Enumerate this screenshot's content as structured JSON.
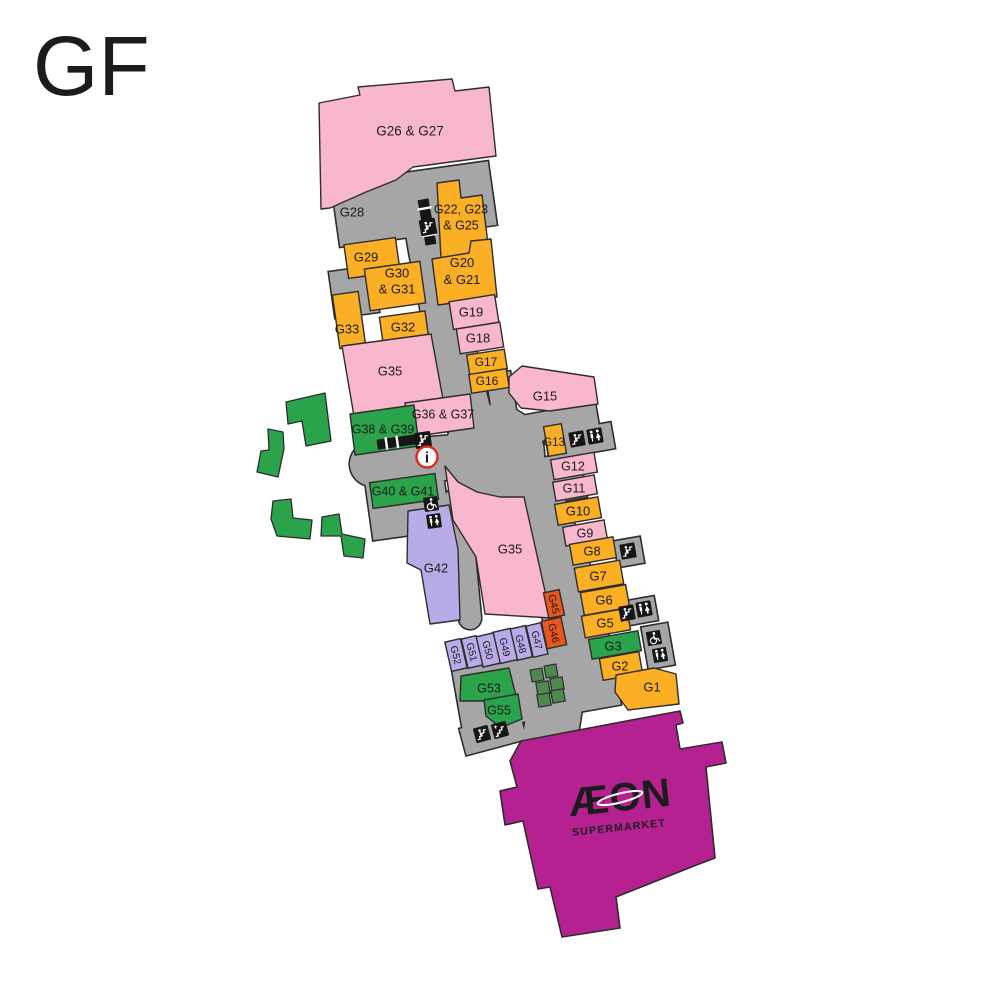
{
  "floor_label": "GF",
  "palette": {
    "pink": "#F8B7CD",
    "orange": "#FBAF24",
    "green": "#2BA34A",
    "lavender": "#B9ABE8",
    "red_orange": "#E8581C",
    "magenta": "#B62191",
    "corridor_gray": "#A6A6A6",
    "outline": "#2D2D2D",
    "planter_green": "#4E8A50",
    "landscape_green": "#2BA34A",
    "info_red": "#DD2B1C"
  },
  "rooms": [
    {
      "id": "g26_27",
      "label": "G26 & G27",
      "category": "pink"
    },
    {
      "id": "g28",
      "label": "G28",
      "category": "corridor"
    },
    {
      "id": "g22_25",
      "label": "G22, G23 & G25",
      "lines": [
        "G22, G23",
        "& G25"
      ],
      "category": "orange"
    },
    {
      "id": "g29",
      "label": "G29",
      "category": "orange"
    },
    {
      "id": "g30_31",
      "label": "G30 & G31",
      "lines": [
        "G30",
        "& G31"
      ],
      "category": "orange"
    },
    {
      "id": "g32",
      "label": "G32",
      "category": "orange"
    },
    {
      "id": "g33",
      "label": "G33",
      "category": "orange"
    },
    {
      "id": "g35_upper",
      "label": "G35",
      "category": "pink"
    },
    {
      "id": "g20_21",
      "label": "G20 & G21",
      "lines": [
        "G20",
        "& G21"
      ],
      "category": "orange"
    },
    {
      "id": "g19",
      "label": "G19",
      "category": "pink"
    },
    {
      "id": "g18",
      "label": "G18",
      "category": "pink"
    },
    {
      "id": "g17",
      "label": "G17",
      "category": "orange"
    },
    {
      "id": "g16",
      "label": "G16",
      "category": "orange"
    },
    {
      "id": "g15",
      "label": "G15",
      "category": "pink"
    },
    {
      "id": "g36_37",
      "label": "G36 & G37",
      "category": "pink"
    },
    {
      "id": "g38_39",
      "label": "G38 & G39",
      "category": "green"
    },
    {
      "id": "g13",
      "label": "G13",
      "category": "orange"
    },
    {
      "id": "g12",
      "label": "G12",
      "category": "pink"
    },
    {
      "id": "g11",
      "label": "G11",
      "category": "pink"
    },
    {
      "id": "g10",
      "label": "G10",
      "category": "orange"
    },
    {
      "id": "g9",
      "label": "G9",
      "category": "pink"
    },
    {
      "id": "g8",
      "label": "G8",
      "category": "orange"
    },
    {
      "id": "g7",
      "label": "G7",
      "category": "orange"
    },
    {
      "id": "g6",
      "label": "G6",
      "category": "orange"
    },
    {
      "id": "g5",
      "label": "G5",
      "category": "orange"
    },
    {
      "id": "g3",
      "label": "G3",
      "category": "green"
    },
    {
      "id": "g2",
      "label": "G2",
      "category": "orange"
    },
    {
      "id": "g1",
      "label": "G1",
      "category": "orange"
    },
    {
      "id": "g40_41",
      "label": "G40 & G41",
      "category": "green"
    },
    {
      "id": "g42",
      "label": "G42",
      "category": "lavender"
    },
    {
      "id": "g35_lower",
      "label": "G35",
      "category": "pink"
    },
    {
      "id": "g45",
      "label": "G45",
      "category": "red_orange"
    },
    {
      "id": "g46",
      "label": "G46",
      "category": "red_orange"
    },
    {
      "id": "g47",
      "label": "G47",
      "category": "lavender"
    },
    {
      "id": "g48",
      "label": "G48",
      "category": "lavender"
    },
    {
      "id": "g49",
      "label": "G49",
      "category": "lavender"
    },
    {
      "id": "g50",
      "label": "G50",
      "category": "lavender"
    },
    {
      "id": "g51",
      "label": "G51",
      "category": "lavender"
    },
    {
      "id": "g52",
      "label": "G52",
      "category": "lavender"
    },
    {
      "id": "g53",
      "label": "G53",
      "category": "green"
    },
    {
      "id": "g55",
      "label": "G55",
      "category": "green"
    }
  ],
  "anchor": {
    "id": "aeon",
    "logo": "ÆON",
    "sub": "SUPERMARKET",
    "category": "magenta"
  },
  "icons": [
    {
      "id": "esc-top",
      "type": "escalator"
    },
    {
      "id": "esc-plaza",
      "type": "escalator"
    },
    {
      "id": "info-plaza",
      "type": "information"
    },
    {
      "id": "esc-g13",
      "type": "escalator"
    },
    {
      "id": "wc-g13",
      "type": "toilets"
    },
    {
      "id": "esc-g8",
      "type": "escalator"
    },
    {
      "id": "esc-g5",
      "type": "escalator"
    },
    {
      "id": "wc-g5",
      "type": "toilets"
    },
    {
      "id": "access-g3",
      "type": "accessible-toilet"
    },
    {
      "id": "wc-g3",
      "type": "toilets"
    },
    {
      "id": "access-g40",
      "type": "accessible-toilet"
    },
    {
      "id": "wc-g40",
      "type": "toilets"
    },
    {
      "id": "esc-g55",
      "type": "escalator"
    },
    {
      "id": "stairs-g55",
      "type": "stairs"
    }
  ]
}
